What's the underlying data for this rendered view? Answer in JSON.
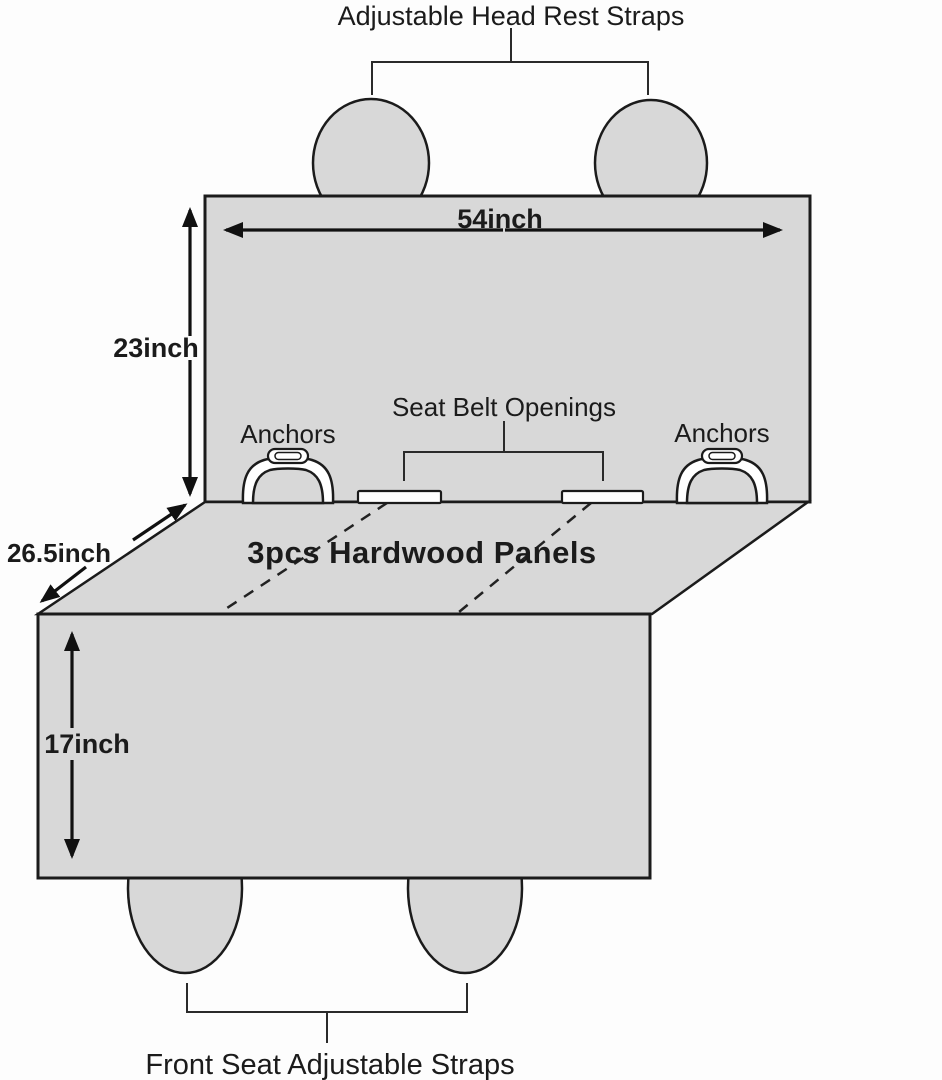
{
  "diagram": {
    "subject": "pet-car-back-seat-cover-dimension-diagram",
    "labels": {
      "head_rest": "Adjustable Head Rest Straps",
      "seat_belt": "Seat Belt Openings",
      "anchors_left": "Anchors",
      "anchors_right": "Anchors",
      "panels": "3pcs Hardwood Panels",
      "front_straps": "Front Seat Adjustable Straps"
    },
    "dims": {
      "back_width": "54inch",
      "back_height": "23inch",
      "seat_depth": "26.5inch",
      "front_height": "17inch"
    },
    "colors": {
      "fabric_fill": "#d8d8d8",
      "outline": "#1b1b1b",
      "background": "#fdfdfd",
      "slot_fill": "#ffffff"
    }
  }
}
